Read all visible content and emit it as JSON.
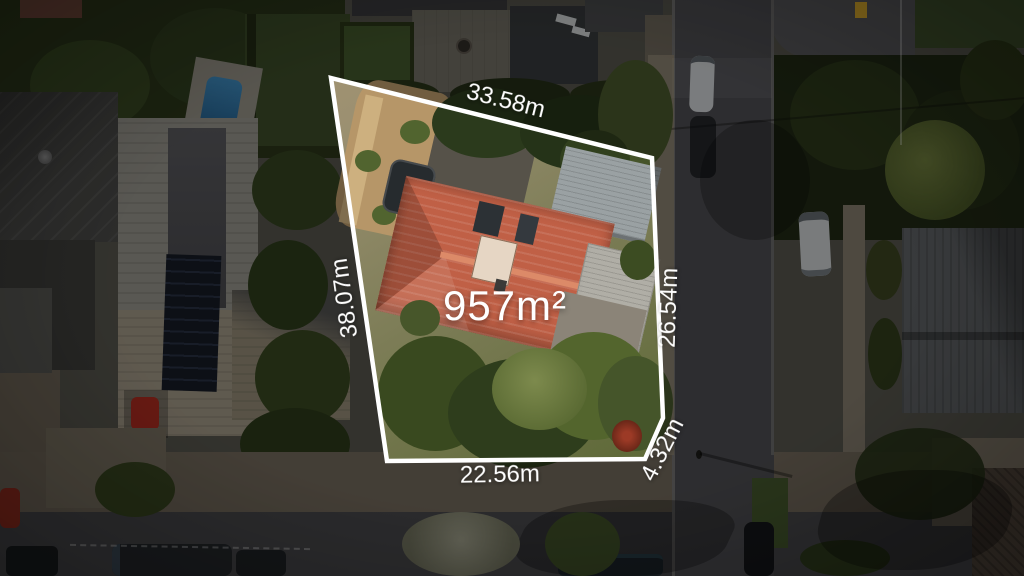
{
  "image_type": "aerial-property-photograph",
  "overlay": {
    "area_label": "957m²",
    "dimensions": {
      "top": "33.58m",
      "left": "38.07m",
      "right": "26.54m",
      "bottom": "22.56m",
      "corner": "4.32m"
    }
  },
  "colors": {
    "boundary_line": "#ffffff",
    "label_text": "#ffffff",
    "dim_overlay": "rgba(0,0,0,0.38)",
    "subject_roof": "#c06046",
    "asphalt": "#4a4a4e",
    "vegetation_dark": "#2c3a1d",
    "dirt_ground": "#b69668"
  }
}
